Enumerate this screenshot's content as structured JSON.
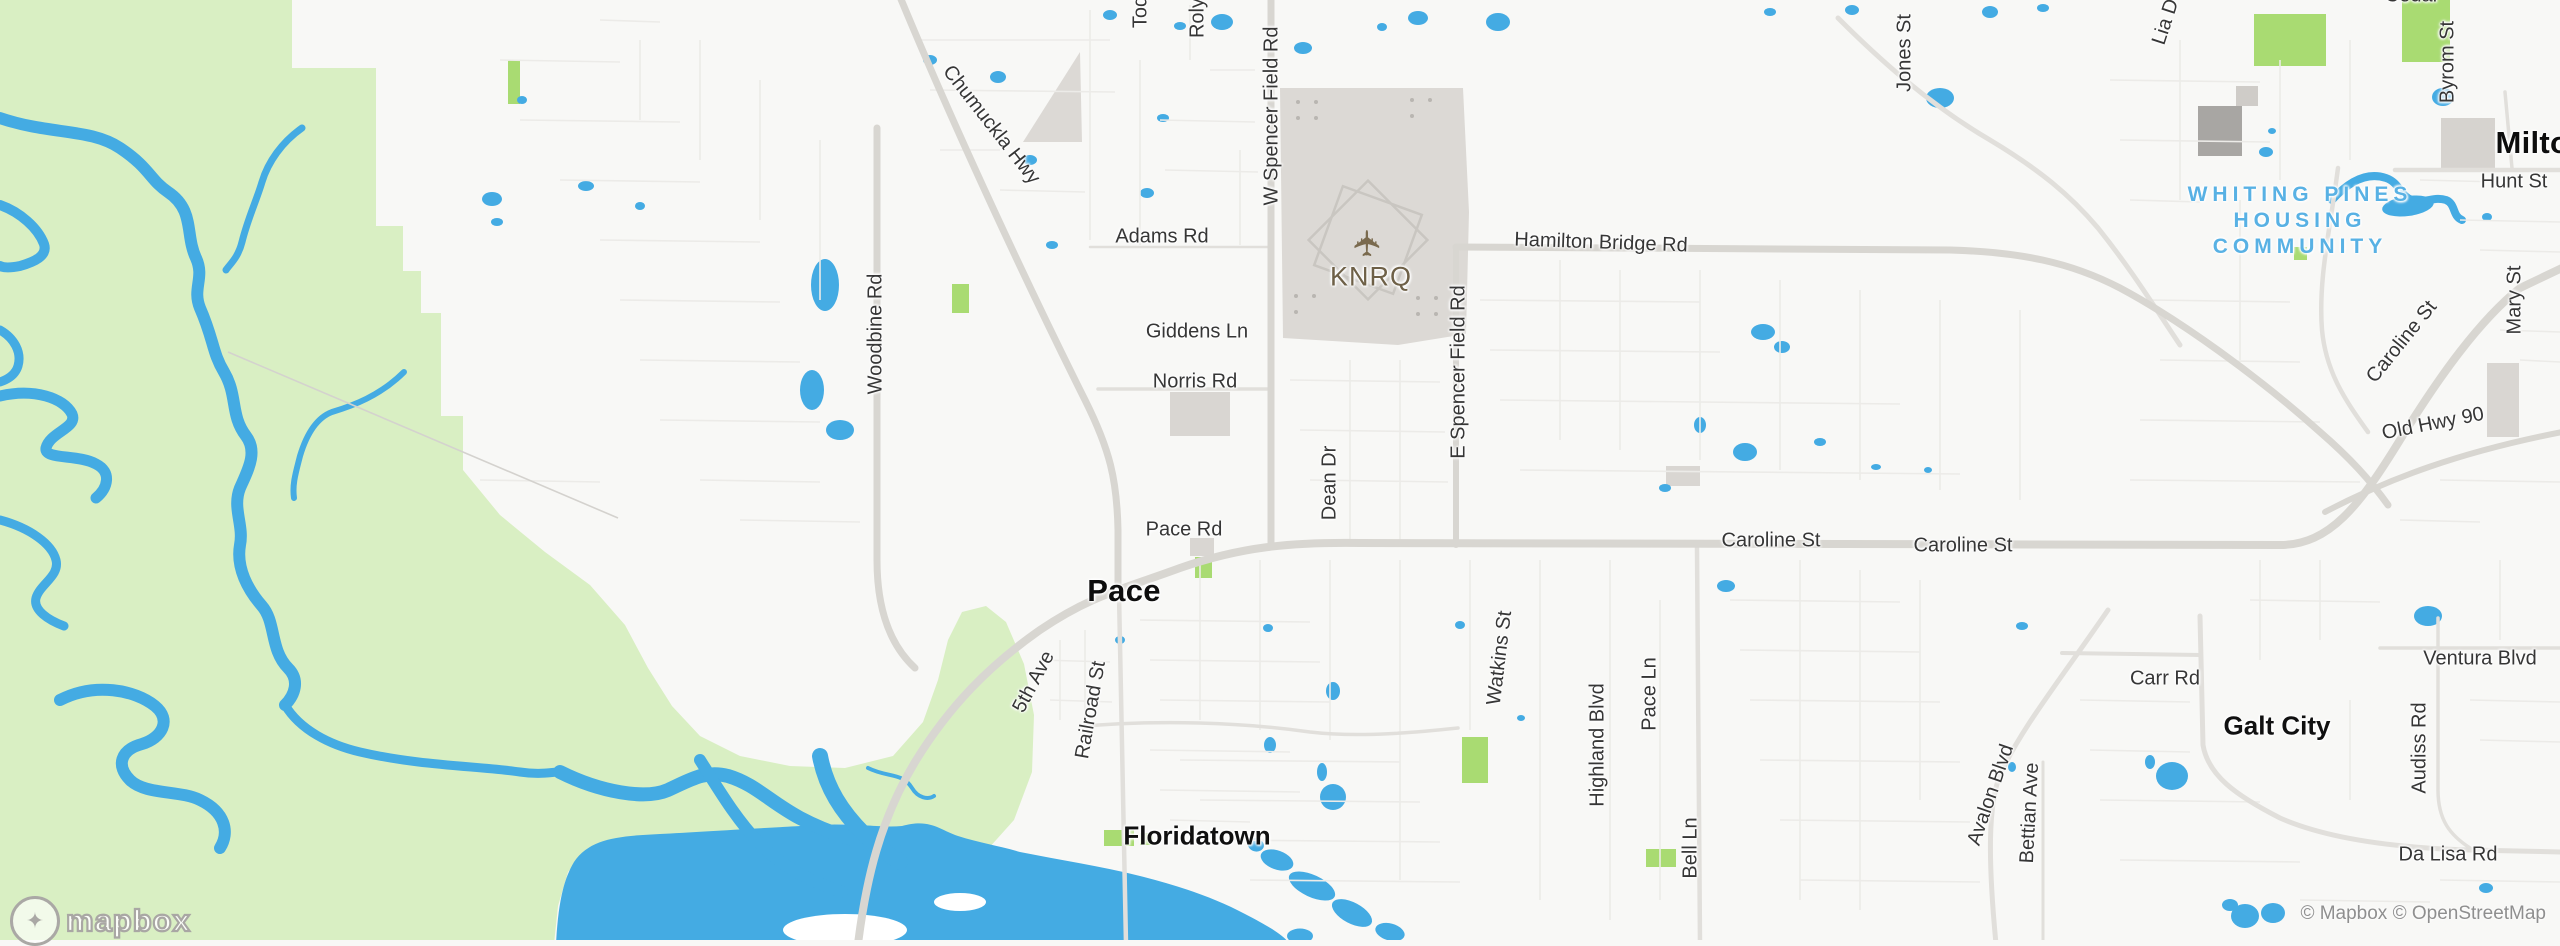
{
  "map": {
    "attribution": "© Mapbox © OpenStreetMap",
    "watermark": "mapbox",
    "colors": {
      "water": "#44abe3",
      "wetland": "#d9efc3",
      "park": "#a9db72",
      "land": "#f8f8f6",
      "road_major": "#d8d6d1",
      "road_mid": "#e1dfdb",
      "road_minor": "#ecebe8",
      "building": "#d9d6d2",
      "airport": "#dcd9d5",
      "area_label_blue": "#58b1e4",
      "airport_label": "#6e6047"
    },
    "icons": {
      "airport_plane": "✈",
      "brand_pin": "✦"
    },
    "labels": [
      {
        "text": "Tod",
        "kind": "road"
      },
      {
        "text": "Roly",
        "kind": "road"
      },
      {
        "text": "W Spencer Field Rd",
        "kind": "road"
      },
      {
        "text": "Chumuckla Hwy",
        "kind": "road"
      },
      {
        "text": "Adams Rd",
        "kind": "road"
      },
      {
        "text": "Woodbine Rd",
        "kind": "road"
      },
      {
        "text": "Giddens Ln",
        "kind": "road"
      },
      {
        "text": "Norris Rd",
        "kind": "road"
      },
      {
        "text": "KNRQ",
        "kind": "airport"
      },
      {
        "text": "Hamilton Bridge Rd",
        "kind": "road"
      },
      {
        "text": "E Spencer Field Rd",
        "kind": "road"
      },
      {
        "text": "Dean Dr",
        "kind": "road"
      },
      {
        "text": "Pace Rd",
        "kind": "road"
      },
      {
        "text": "Pace",
        "kind": "town"
      },
      {
        "text": "Caroline St",
        "kind": "road"
      },
      {
        "text": "Caroline St",
        "kind": "road"
      },
      {
        "text": "Jones St",
        "kind": "road"
      },
      {
        "text": "Lia D",
        "kind": "road"
      },
      {
        "text": "Cedar",
        "kind": "road"
      },
      {
        "text": "Byrom St",
        "kind": "road"
      },
      {
        "text": "Hunt St",
        "kind": "road"
      },
      {
        "text": "Milton",
        "kind": "town"
      },
      {
        "text": "WHITING PINES",
        "kind": "area"
      },
      {
        "text": "HOUSING",
        "kind": "area"
      },
      {
        "text": "COMMUNITY",
        "kind": "area"
      },
      {
        "text": "Mary St",
        "kind": "road"
      },
      {
        "text": "Caroline St",
        "kind": "road"
      },
      {
        "text": "Old Hwy 90",
        "kind": "road"
      },
      {
        "text": "Watkins St",
        "kind": "road"
      },
      {
        "text": "Highland Blvd",
        "kind": "road"
      },
      {
        "text": "Pace Ln",
        "kind": "road"
      },
      {
        "text": "Bell Ln",
        "kind": "road"
      },
      {
        "text": "5th Ave",
        "kind": "road"
      },
      {
        "text": "Railroad St",
        "kind": "road"
      },
      {
        "text": "Floridatown",
        "kind": "town"
      },
      {
        "text": "Carr Rd",
        "kind": "road"
      },
      {
        "text": "Galt City",
        "kind": "town"
      },
      {
        "text": "Ventura Blvd",
        "kind": "road"
      },
      {
        "text": "Audiss Rd",
        "kind": "road"
      },
      {
        "text": "Avalon Blvd",
        "kind": "road"
      },
      {
        "text": "Bettian Ave",
        "kind": "road"
      },
      {
        "text": "Da Lisa Rd",
        "kind": "road"
      }
    ]
  }
}
